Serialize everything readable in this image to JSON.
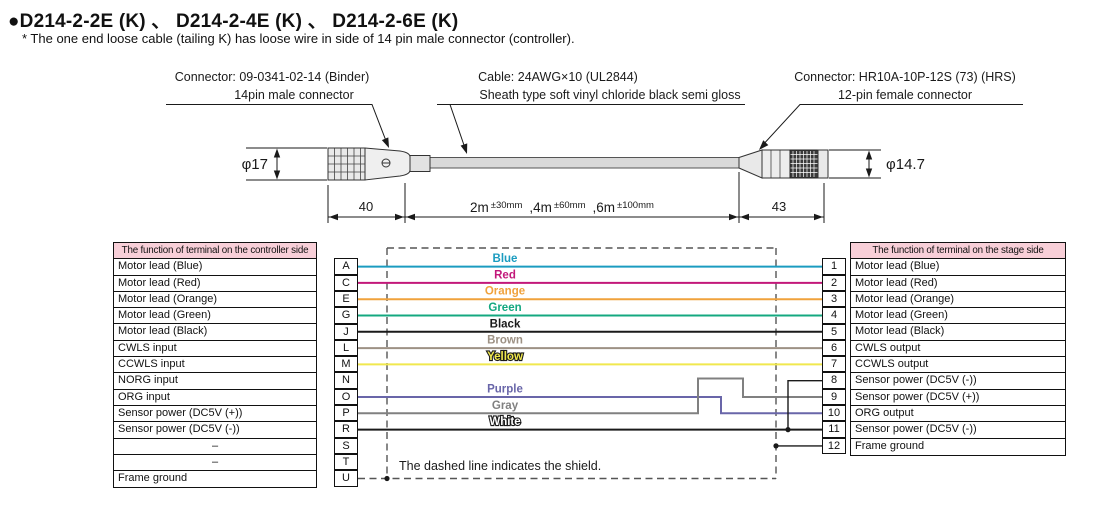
{
  "title": "●D214-2-2E (K) 、 D214-2-4E (K) 、 D214-2-6E (K)",
  "subtitle": "* The one end loose cable (tailing K) has loose wire in side of 14 pin male connector (controller).",
  "labels": {
    "left_connector": {
      "line1": "Connector: 09-0341-02-14 (Binder)",
      "line2": "14pin male connector"
    },
    "cable": {
      "line1": "Cable: 24AWG×10 (UL2844)",
      "line2": "Sheath type soft vinyl chloride black semi gloss"
    },
    "right_connector": {
      "line1": "Connector: HR10A-10P-12S (73) (HRS)",
      "line2": "12-pin female connector"
    }
  },
  "dimensions": {
    "left_diameter": "φ17",
    "right_diameter": "φ14.7",
    "left_connector_length": "40",
    "right_connector_length": "43",
    "cable_lengths": [
      {
        "len": "2m",
        "tol": "±30mm"
      },
      {
        "len": ",4m",
        "tol": "±60mm"
      },
      {
        "len": ",6m",
        "tol": "±100mm"
      }
    ]
  },
  "left_table": {
    "header": "The function of terminal on the controller side",
    "rows": [
      {
        "function": "Motor lead (Blue)",
        "pin": "A"
      },
      {
        "function": "Motor lead (Red)",
        "pin": "C"
      },
      {
        "function": "Motor lead (Orange)",
        "pin": "E"
      },
      {
        "function": "Motor lead (Green)",
        "pin": "G"
      },
      {
        "function": "Motor lead (Black)",
        "pin": "J"
      },
      {
        "function": "CWLS input",
        "pin": "L"
      },
      {
        "function": "CCWLS input",
        "pin": "M"
      },
      {
        "function": "NORG input",
        "pin": "N"
      },
      {
        "function": "ORG input",
        "pin": "O"
      },
      {
        "function": "Sensor power (DC5V (+))",
        "pin": "P"
      },
      {
        "function": "Sensor power (DC5V (-))",
        "pin": "R"
      },
      {
        "function": "–",
        "pin": "S"
      },
      {
        "function": "–",
        "pin": "T"
      },
      {
        "function": "Frame ground",
        "pin": "U"
      }
    ]
  },
  "right_table": {
    "header": "The function of terminal on the stage side",
    "rows": [
      {
        "pin": "1",
        "function": "Motor lead (Blue)"
      },
      {
        "pin": "2",
        "function": "Motor lead (Red)"
      },
      {
        "pin": "3",
        "function": "Motor lead (Orange)"
      },
      {
        "pin": "4",
        "function": "Motor lead (Green)"
      },
      {
        "pin": "5",
        "function": "Motor lead (Black)"
      },
      {
        "pin": "6",
        "function": "CWLS output"
      },
      {
        "pin": "7",
        "function": "CCWLS output"
      },
      {
        "pin": "8",
        "function": "Sensor power (DC5V (-))"
      },
      {
        "pin": "9",
        "function": "Sensor power (DC5V (+))"
      },
      {
        "pin": "10",
        "function": "ORG output"
      },
      {
        "pin": "11",
        "function": "Sensor power (DC5V (-))"
      },
      {
        "pin": "12",
        "function": "Frame ground"
      }
    ]
  },
  "wires": [
    {
      "label": "Blue",
      "color": "#1b9cc0",
      "text_fill": "#1b9cc0"
    },
    {
      "label": "Red",
      "color": "#c2187a",
      "text_fill": "#c2187a"
    },
    {
      "label": "Orange",
      "color": "#f0a23c",
      "text_fill": "#f0a23c"
    },
    {
      "label": "Green",
      "color": "#14a880",
      "text_fill": "#14a880"
    },
    {
      "label": "Black",
      "color": "#1a1a1a",
      "text_fill": "#1a1a1a"
    },
    {
      "label": "Brown",
      "color": "#9d9184",
      "text_fill": "#9d9184"
    },
    {
      "label": "Yellow",
      "color": "#f0e84e",
      "text_fill": "#f0e84e"
    },
    {
      "label": "Purple",
      "color": "#6966a9",
      "text_fill": "#6966a9"
    },
    {
      "label": "Gray",
      "color": "#808080",
      "text_fill": "#808080"
    },
    {
      "label": "White",
      "color": "#1a1a1a",
      "text_fill": "#ffffff"
    }
  ],
  "shield_note": "The dashed line indicates the shield.",
  "colors": {
    "header_bg": "#f8cfd8",
    "line": "#1a1a1a"
  }
}
